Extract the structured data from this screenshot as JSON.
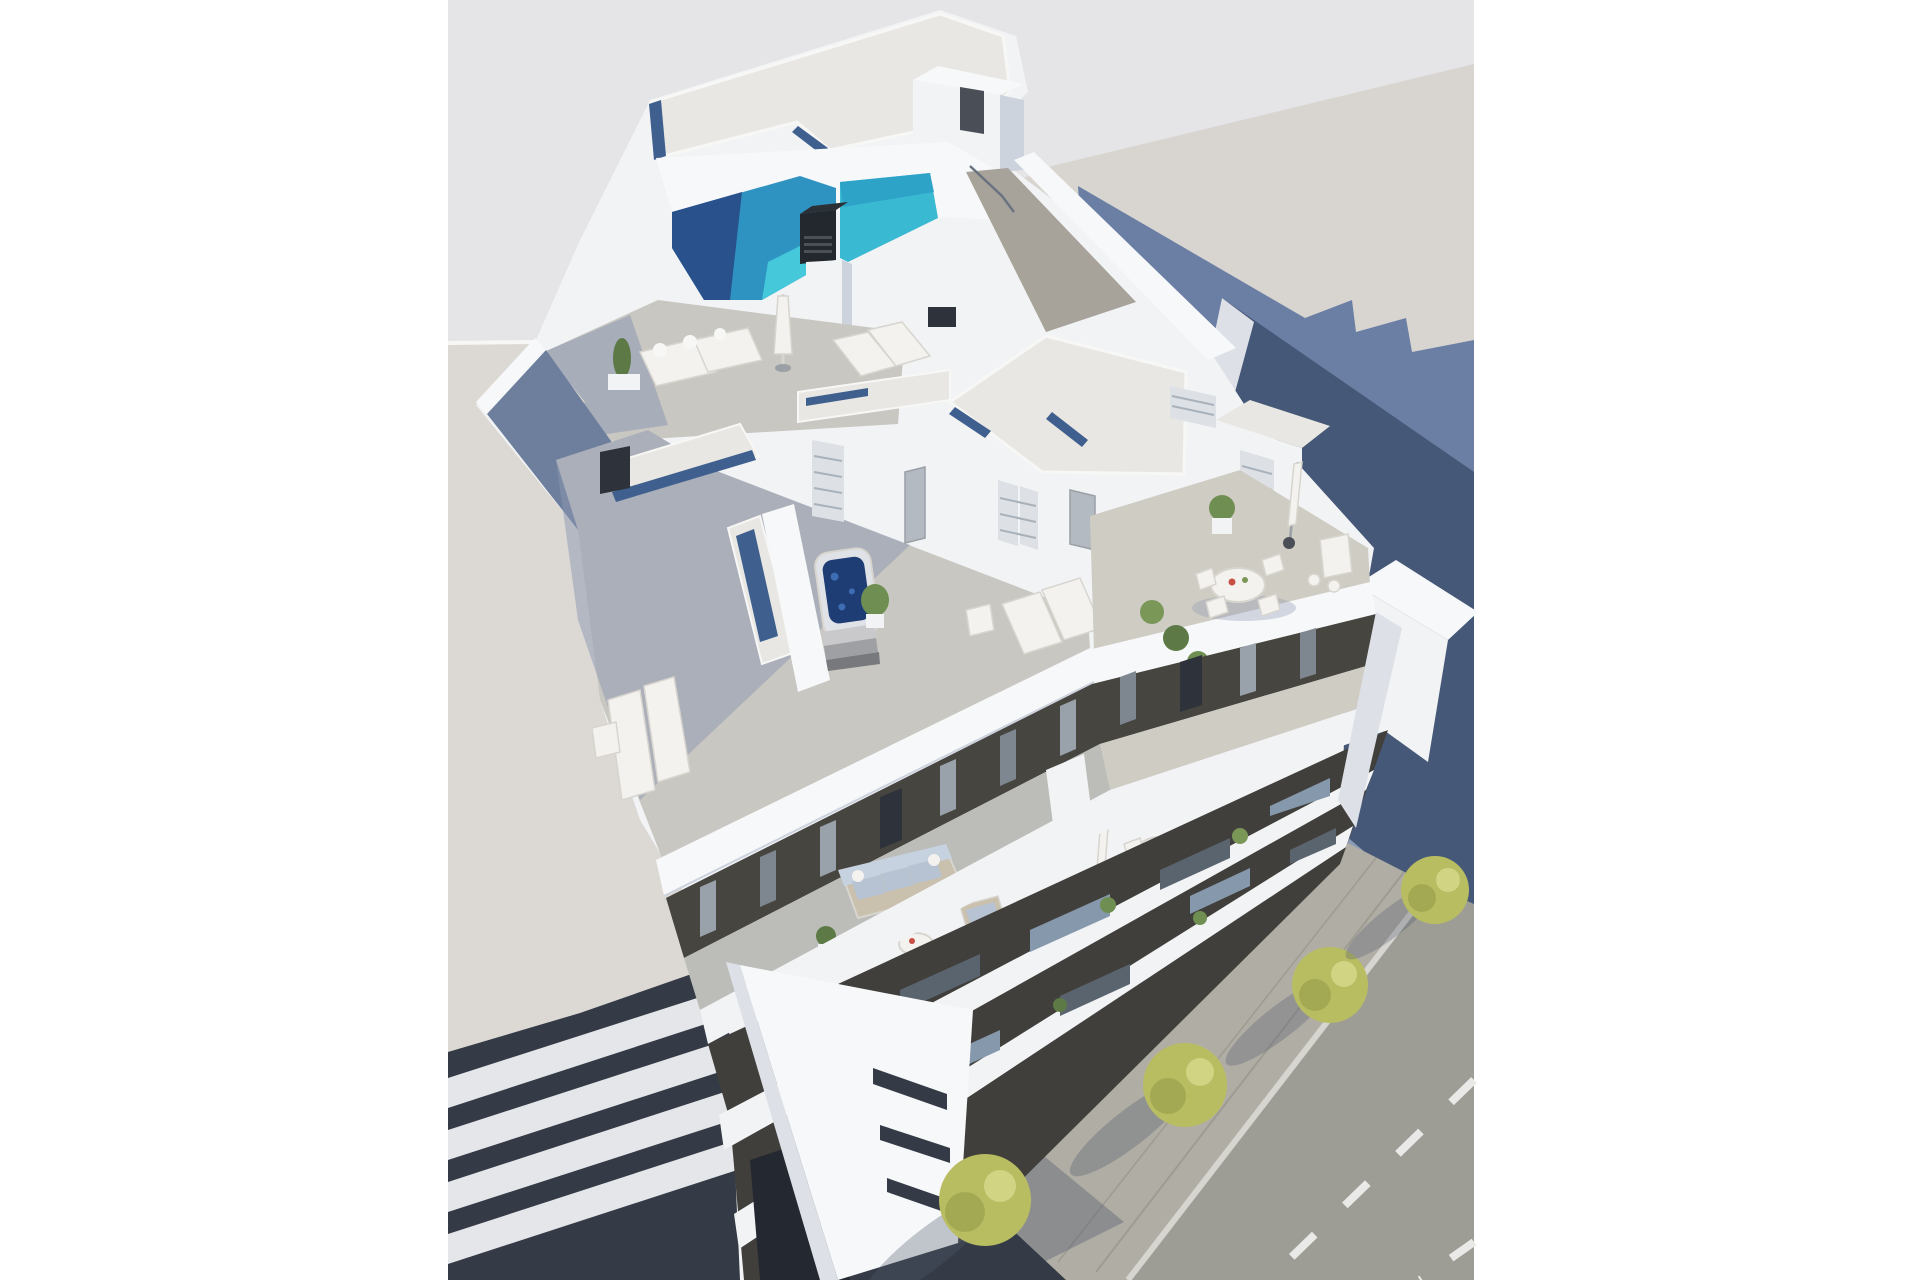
{
  "palette": {
    "page_bg": "#ffffff",
    "bg_cool": "#e5e5e7",
    "ground_warm": "#d8d5d1",
    "shadow_blue": "#6b7fa5",
    "shadow_cast": "#4e596b",
    "navy_shade": "#465877",
    "navy_light": "#8b9cb8",
    "wall_lit": "#f2f3f5",
    "wall_bright": "#f7f8fa",
    "wall_shade": "#ccd3dd",
    "wall_softshade": "#dde1e7",
    "warm_wall": "#dcd9d4",
    "gravel": "#e9e7e3",
    "fascia": "#f7f7f6",
    "slat_blue": "#3f608e",
    "pool_deep": "#29518c",
    "pool_mid": "#2f93c2",
    "pool_light": "#45c8d9",
    "pool_cyan": "#39b9d2",
    "pool_cyan2": "#2b9fc6",
    "chimney_dark": "#23272e",
    "chimney_top": "#2b3037",
    "chimney_slat": "#4a5058",
    "walkway": "#a7a29a",
    "deck_light": "#c9c7c1",
    "deck_mid": "#bcbdb9",
    "deck_warm": "#cfccc4",
    "deck_shadow": "#8b97b2",
    "deck_blue": "#6e7f9d",
    "dark_recess": "#474540",
    "dark_facade": "#413f3b",
    "dark_void": "#2e333b",
    "gap_dark": "#242931",
    "slab_dark": "#343b46",
    "slab_white": "#e5e6e9",
    "glass_blue": "#8698ac",
    "glass_dark": "#5a646e",
    "curtain_light": "#99a2ab",
    "curtain_mid": "#7e868f",
    "door_gray": "#b4bac1",
    "shutter": "#dde1e6",
    "shutter_line": "#a9b1ba",
    "furn_white": "#f3f2ef",
    "furn_stroke": "#d8d5cf",
    "cushion_blue": "#b7c3d2",
    "cushion_lite": "#c7d2e0",
    "sofa_frame": "#c9c0ae",
    "tub_shell": "#dfe3e7",
    "tub_water": "#1e3d75",
    "tub_sparkle": "#3f6db4",
    "tub_step1": "#c9c9cb",
    "tub_step2": "#9fa0a3",
    "tub_step3": "#77797d",
    "wood_tub": "#b3aa9b",
    "plant_green": "#6f8f52",
    "plant_dark": "#5d7a46",
    "plant_lite": "#7a9757",
    "tree_green": "#b9bd62",
    "tree_dark": "#9aa04b",
    "tree_lite": "#d6d98c",
    "trunk": "#5f6356",
    "sidewalk": "#b0ada5",
    "sidewalk_joint": "#9e9b93",
    "road": "#9d9d95",
    "road_dash": "#e9e9e7",
    "curb": "#d6d5d0",
    "metal": "#9aa0a6",
    "base_dark": "#4a4f57",
    "accent_red": "#c94f44",
    "rail": "#6a7380"
  },
  "scene": {
    "objects": [
      "modern white apartment building (aerial render)",
      "rooftop swimming pool with turquoise water",
      "black chimney vent",
      "roof stair bulkhead",
      "gravel flat roofs with glass slots",
      "rooftop solarium with daybeds and closed parasol",
      "jacuzzi hot tub",
      "sun loungers",
      "rooftop dining table with chairs and bar table",
      "balcony terraces with sofa and round table",
      "street-facing facade with white balcony bands",
      "gable wall with slot windows",
      "neighboring building with slab balconies",
      "street with dashed lane markings",
      "sidewalk with yellow-green trees",
      "long blue building shadow on ground"
    ]
  }
}
